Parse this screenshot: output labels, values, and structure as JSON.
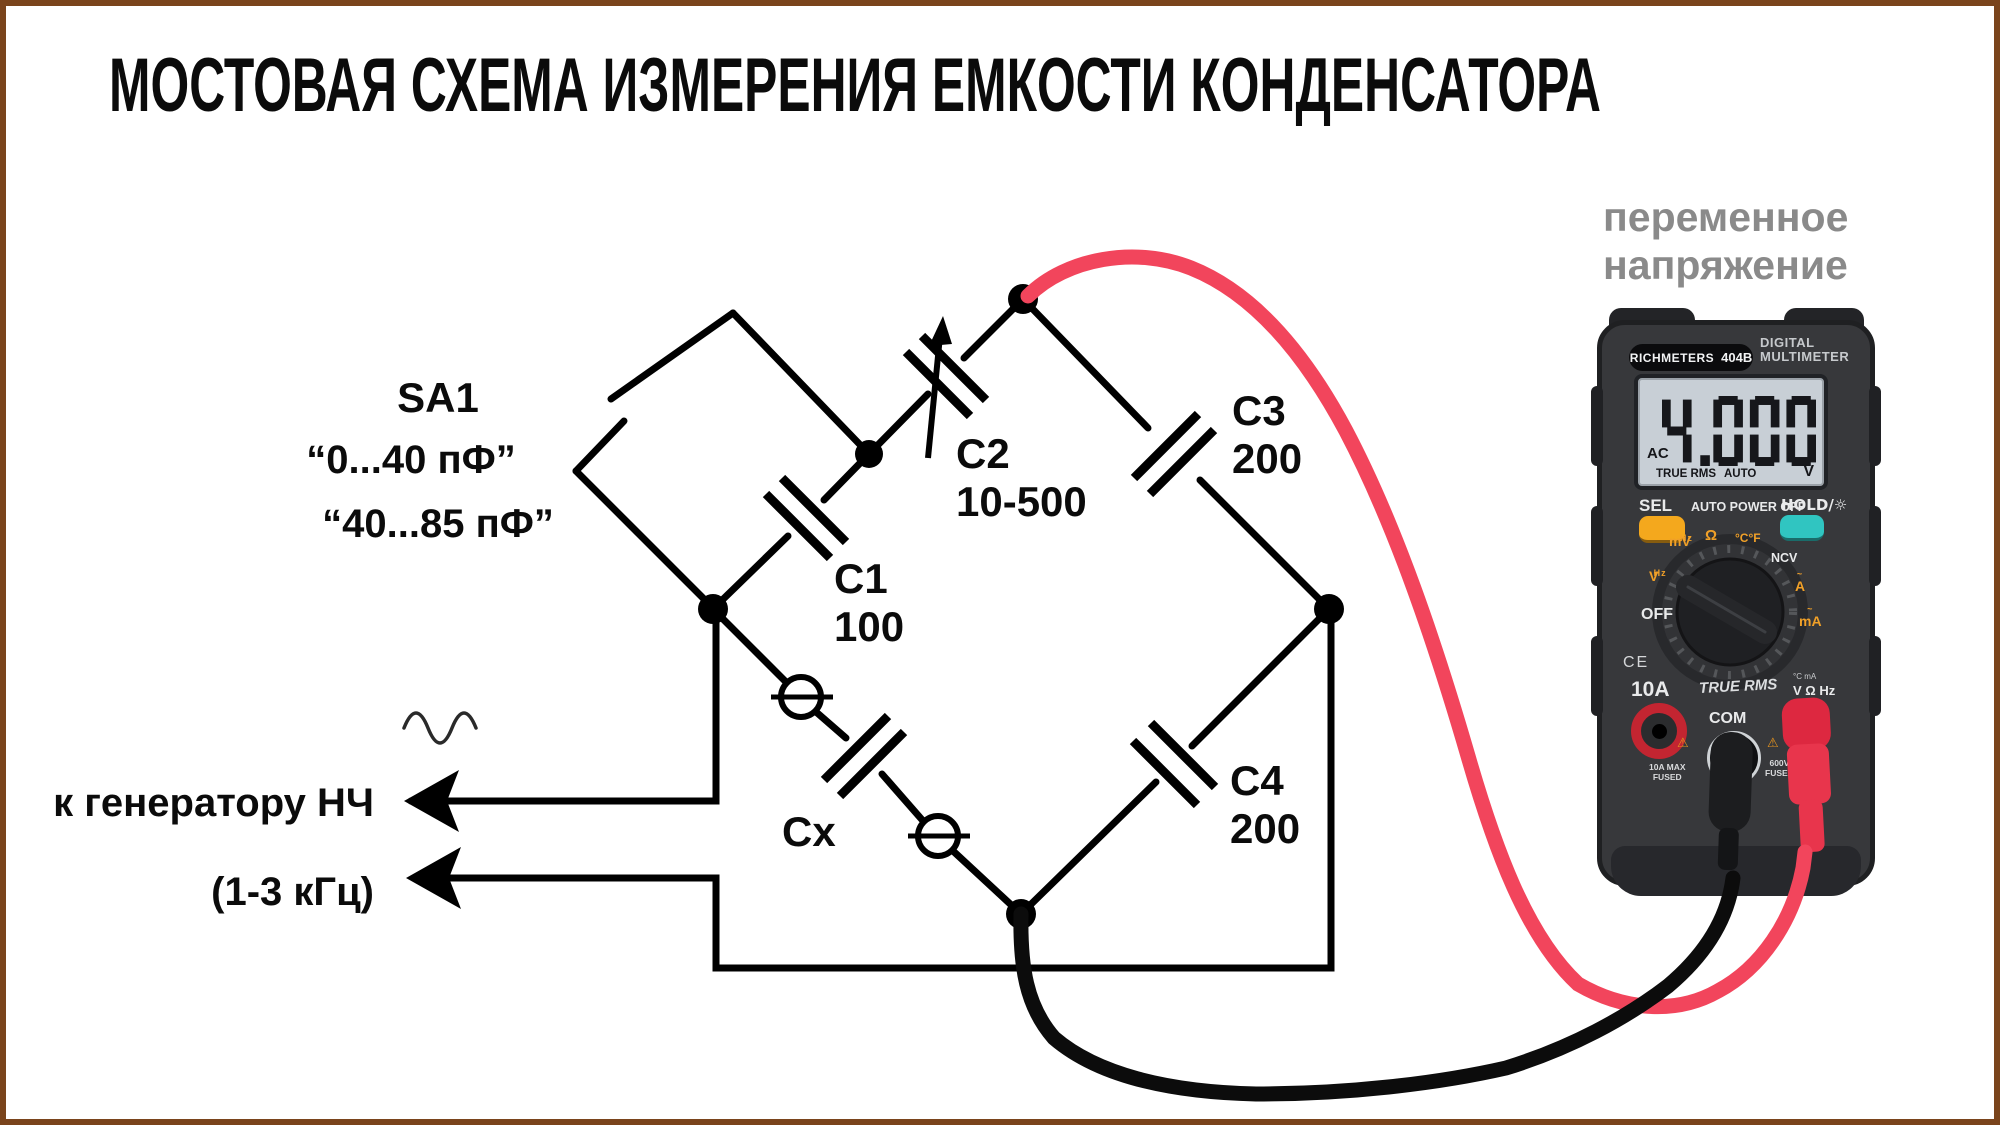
{
  "title": "МОСТОВАЯ СХЕМА ИЗМЕРЕНИЯ ЕМКОСТИ КОНДЕНСАТОРА",
  "notes": {
    "meter_note_line1": "переменное",
    "meter_note_line2": "напряжение",
    "generator_label": "к генератору НЧ",
    "generator_freq": "(1-3 кГц)"
  },
  "components": {
    "sa1": {
      "ref": "SA1",
      "range1": "“0...40 пФ”",
      "range2": "“40...85 пФ”"
    },
    "c1": {
      "ref": "C1",
      "value": "100"
    },
    "c2": {
      "ref": "C2",
      "value": "10-500"
    },
    "c3": {
      "ref": "C3",
      "value": "200"
    },
    "c4": {
      "ref": "C4",
      "value": "200"
    },
    "cx": {
      "ref": "Cx"
    }
  },
  "multimeter": {
    "brand": "RICHMETERS",
    "model": "404B",
    "device_line1": "DIGITAL",
    "device_line2": "MULTIMETER",
    "display": {
      "mode": "AC",
      "value": "4.000",
      "flag1": "TRUE RMS",
      "flag2": "AUTO",
      "unit": "V"
    },
    "controls": {
      "sel": "SEL",
      "auto_power_off": "AUTO POWER OFF",
      "hold": "HOLD/☼"
    },
    "dial": {
      "off": "OFF",
      "wave": "~",
      "hz": "Hz",
      "v": "V",
      "mv": "mV",
      "ohm": "Ω",
      "temp": "°C°F",
      "ncv": "NCV",
      "amp": "A",
      "milliamp": "mA",
      "bottom_text": "TRUE RMS"
    },
    "marks": {
      "ce": "CE",
      "amp_jack": "10A",
      "com_jack": "COM",
      "volt_jack": "V Ω Hz",
      "volt_jack_icons": "°C mA",
      "amp_fuse1": "10A MAX",
      "amp_fuse2": "FUSED",
      "volt_fuse1": "600V",
      "volt_fuse2": "FUSED",
      "warning": "⚠"
    }
  },
  "colors": {
    "frame_border": "#7a441c",
    "wire_red": "#f2455c",
    "wire_black": "#0c0c0c",
    "probe_red": "#e8354c",
    "note_gray": "#8a8a8a",
    "button_orange": "#f4a81d",
    "button_teal": "#30c5c1",
    "dial_orange": "#f0a028",
    "lcd_background": "#c8cfd6"
  }
}
